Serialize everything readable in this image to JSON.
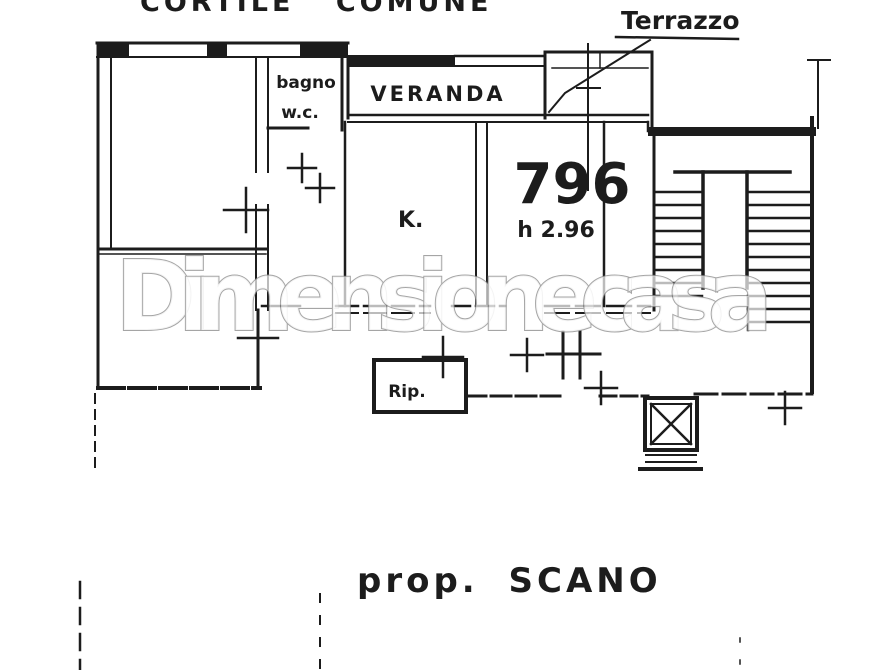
{
  "document": {
    "kind": "scanned floor plan",
    "ink_color": "#1c1c1c",
    "paper_color": "#ffffff",
    "labels": {
      "courtyard": "CORTILE COMUNE",
      "terrace": "Terrazzo",
      "bathroom_line1": "bagno",
      "bathroom_line2": "w.c.",
      "veranda": "VERANDA",
      "kitchen": "K.",
      "room_number": "796",
      "room_height": "h 2.96",
      "storage": "Rip.",
      "owner_caption": "prop. SCANO"
    },
    "watermark": {
      "text": "Dimensionecasa",
      "color": "#8f8f8f"
    }
  }
}
